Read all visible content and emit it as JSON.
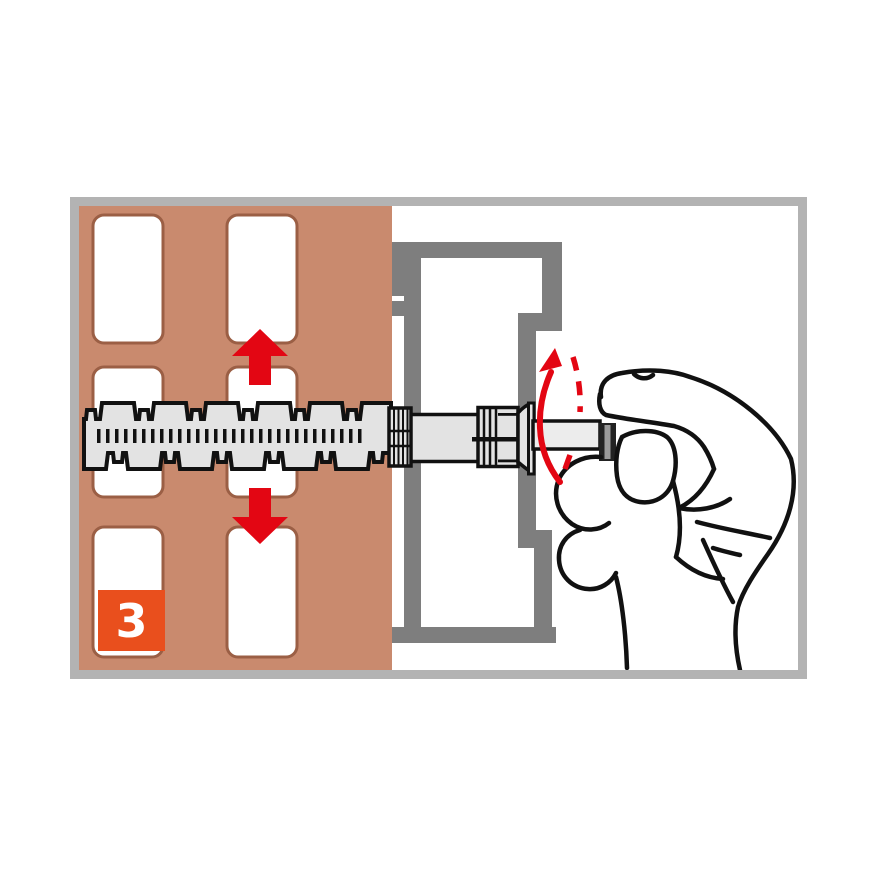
{
  "illustration": {
    "title_semantic": "anchor-installation-step",
    "step_badge": {
      "label": "3"
    },
    "icons": [
      "arrow-up-icon",
      "arrow-down-icon",
      "rotation-arrow-icon",
      "screw-anchor-graphic",
      "hand-graphic",
      "brick-wall-graphic",
      "frame-profile-graphic"
    ],
    "colors": {
      "frame_border": "#b3b3b3",
      "wall": "#c98a6e",
      "hole_outline": "#9b5f45",
      "hole_fill": "#ffffff",
      "profile_gray": "#7e7e7e",
      "anchor_fill": "#e3e3e3",
      "outline_black": "#111111",
      "accent_red": "#e30613",
      "badge_orange": "#e94f1d",
      "badge_text": "#ffffff"
    }
  }
}
